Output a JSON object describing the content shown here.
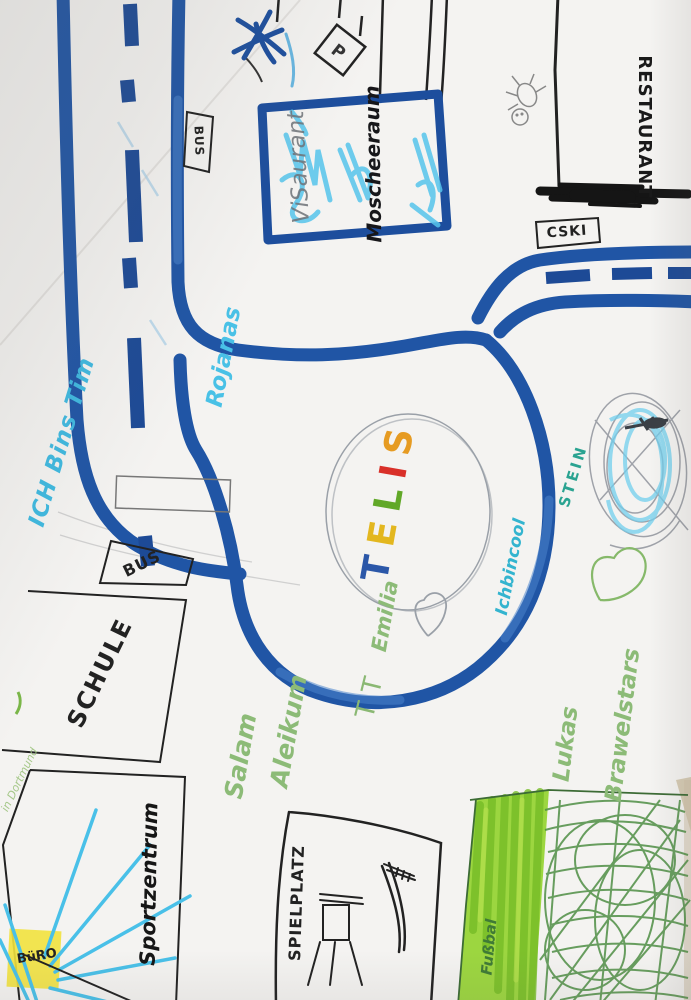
{
  "signs": {
    "parking": "P",
    "bus_sign": "BUS",
    "cski": "CSKI",
    "restaurant": "RESTAURANT",
    "bus_stop": "BUS",
    "schule": "SCHULE",
    "sportzentrum": "Sportzentrum",
    "buero": "BüRO",
    "spielplatz": "SPIELPLATZ"
  },
  "blue_building": {
    "pencil_label": "ViSaurant",
    "marker_label": "Moscheeraum"
  },
  "handwriting": {
    "ich_bins_tim": "ICH Bins Tim",
    "rojanas": "Rojanas",
    "emilia": "Emilia",
    "tt": "TT",
    "ich_bin_cool": "Ichbincool",
    "stein": "STEIN",
    "salam": "Salam",
    "aleikum": "Aleikum",
    "lukas": "Lukas",
    "brawelstars": "Brawelstars",
    "dortmund_note": "in Dortmund",
    "fussbal": "Fußbal"
  },
  "telis": {
    "word": "TELIS",
    "letters": [
      {
        "char": "T",
        "color": "#2b57a8"
      },
      {
        "char": "E",
        "color": "#e3b71f"
      },
      {
        "char": "L",
        "color": "#61a828"
      },
      {
        "char": "I",
        "color": "#d93029"
      },
      {
        "char": "S",
        "color": "#e69b22"
      }
    ]
  },
  "colors": {
    "road_blue": "#2055a5",
    "dash_blue": "#1d4a96",
    "light_blue": "#56c5ec",
    "cyan_text": "#3fb9e0",
    "teal_text": "#33b4cf",
    "green_pencil": "#8cbb77",
    "marker_green": "#97d436",
    "dark_green_pencil": "#4f8f45",
    "highlight_yellow": "#f2e23e",
    "pencil_gray": "#9aa0a8",
    "ink_black": "#1c1c1c"
  }
}
